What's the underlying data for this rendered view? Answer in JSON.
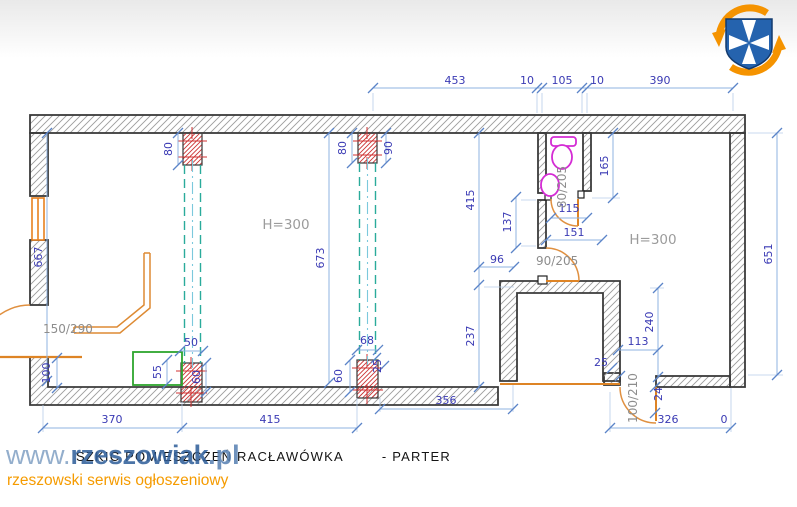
{
  "plan": {
    "rooms": {
      "left_height": "H=300",
      "right_height": "H=300"
    },
    "doors": {
      "entry": "150/290",
      "bathroom": "80/205",
      "hallway": "90/205",
      "back": "100/210"
    },
    "dims": {
      "top": [
        "453",
        "10",
        "105",
        "10",
        "390"
      ],
      "left_total": "667",
      "right_total": "651",
      "mid_total": "673",
      "v415": "415",
      "v237": "237",
      "v137": "137",
      "v165": "165",
      "v240": "240",
      "h96": "96",
      "h151": "151",
      "h115": "115",
      "h113": "113",
      "pillar_top_left": "80",
      "pillar_top_mid_left": "80",
      "pillar_top_mid_right": "90",
      "pillar_bottom_left_top": "50",
      "pillar_bottom_left_side": "55",
      "pillar_bottom_left_right": "60",
      "pillar_bottom_mid_top": "68",
      "pillar_bottom_mid_left": "60",
      "pillar_bottom_mid_right": "25",
      "corner_height": "100",
      "door_back_jamb": "25",
      "door_back_leaf": "24",
      "bottom": [
        "370",
        "415",
        "356",
        "326",
        "0"
      ]
    },
    "colors": {
      "dimension_text": "#3a3ab4",
      "dimension_line": "#8fb3e0",
      "wall_outline": "#3b3b3b",
      "accent_orange": "#e8861e",
      "beam_teal": "#2aab9b",
      "pillar_red": "#cc3333",
      "fixture_magenta": "#d42bd4",
      "furniture_green": "#2ea52e"
    }
  },
  "footer": {
    "watermark_www": "www.",
    "watermark_name": "rzeszowiak",
    "watermark_tld": ".pl",
    "tagline": "rzeszowski serwis ogłoszeniowy",
    "drawing_title": "SZKIC POMIESZCZEŃ RACŁAWÓWKA",
    "drawing_title_suffix": "- PARTER"
  }
}
